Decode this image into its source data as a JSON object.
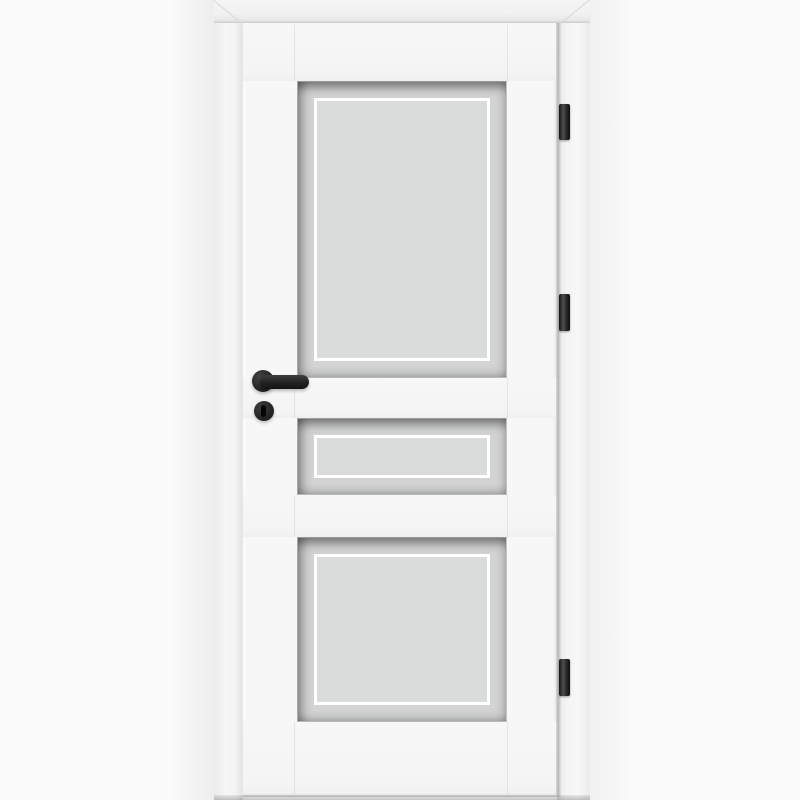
{
  "scene": {
    "subject": "White interior door with three frosted glass panels, black lever handle and three black hinges",
    "type": "product-photo",
    "background_color": "#fbfbfb"
  },
  "door": {
    "label": "Door leaf",
    "leaf_color": "#f7f7f8",
    "frame_label": "Door frame casing",
    "frame_color": "#f3f3f4",
    "glass_color": "#d3d4d4",
    "glass_inner_color": "#dadbdb",
    "glass_outline_color": "#ffffff",
    "panel_count": 3,
    "panels": [
      {
        "name": "top glass panel",
        "size": "large"
      },
      {
        "name": "middle glass panel",
        "size": "narrow"
      },
      {
        "name": "bottom glass panel",
        "size": "large"
      }
    ],
    "hardware": {
      "color": "#1f2020",
      "handle": {
        "label": "Black lever handle",
        "type": "lever",
        "side": "left"
      },
      "keyhole": {
        "label": "Round keyhole escutcheon",
        "type": "round-escutcheon"
      },
      "hinges": {
        "label": "Hinge",
        "count": 3,
        "side": "right",
        "color": "#2a2a2a"
      }
    }
  }
}
